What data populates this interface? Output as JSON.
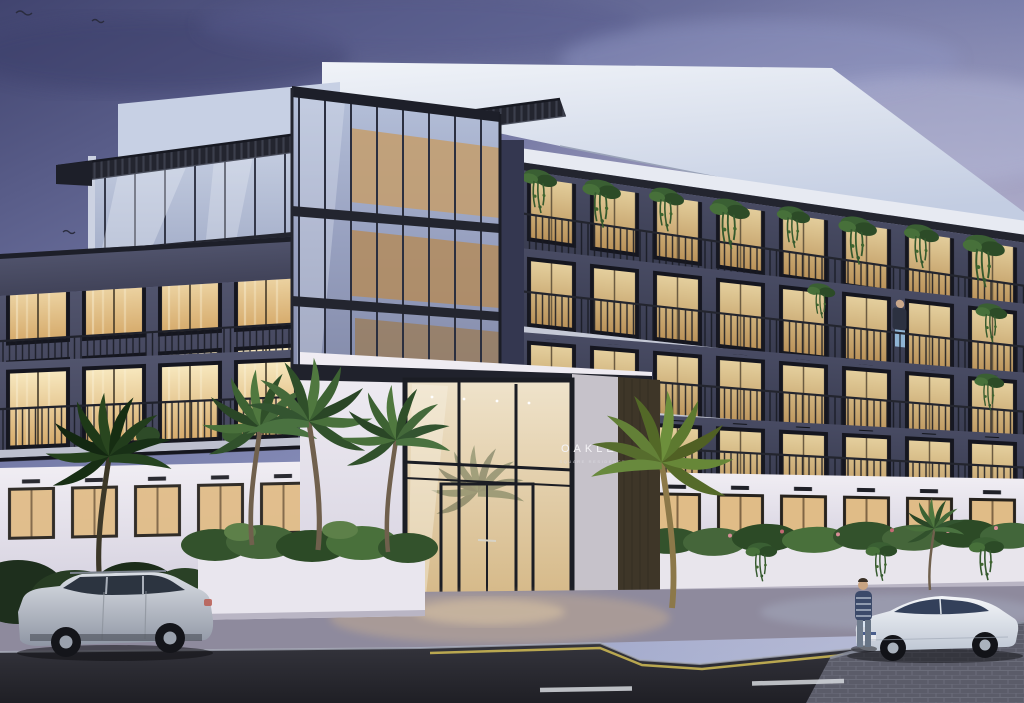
{
  "scene": {
    "description_sign": {
      "name": "OAKLEY",
      "subtitle": "SQUARE RESIDENCES"
    },
    "palette": {
      "sky_top": "#41446f",
      "sky_horizon": "#aab4d4",
      "facade_dark": "#43465e",
      "facade_white": "#efecf2",
      "window_warm": "#f6dfa8",
      "vegetation": "#3a5f33",
      "road": "#26262c",
      "curb_line_yellow": "#c9b553"
    }
  }
}
